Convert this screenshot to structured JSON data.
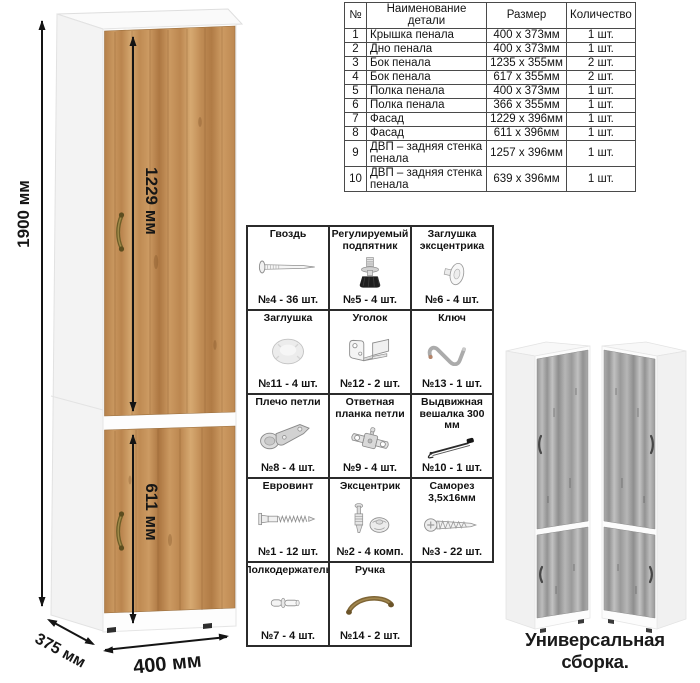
{
  "diagram": {
    "dimensions": {
      "height": "1900 мм",
      "upper_door": "1229 мм",
      "lower_door": "611 мм",
      "depth": "375 мм",
      "width": "400 мм"
    }
  },
  "parts_table": {
    "headers": {
      "num": "№",
      "name": "Наименование детали",
      "size": "Размер",
      "qty": "Количество"
    },
    "rows": [
      {
        "num": "1",
        "name": "Крышка пенала",
        "size": "400 x 373мм",
        "qty": "1 шт."
      },
      {
        "num": "2",
        "name": "Дно пенала",
        "size": "400 x 373мм",
        "qty": "1 шт."
      },
      {
        "num": "3",
        "name": "Бок пенала",
        "size": "1235 x 355мм",
        "qty": "2 шт."
      },
      {
        "num": "4",
        "name": "Бок пенала",
        "size": "617 x 355мм",
        "qty": "2 шт."
      },
      {
        "num": "5",
        "name": "Полка пенала",
        "size": "400 x 373мм",
        "qty": "1 шт."
      },
      {
        "num": "6",
        "name": "Полка пенала",
        "size": "366 x 355мм",
        "qty": "1 шт."
      },
      {
        "num": "7",
        "name": "Фасад",
        "size": "1229 x 396мм",
        "qty": "1 шт."
      },
      {
        "num": "8",
        "name": "Фасад",
        "size": "611 x 396мм",
        "qty": "1 шт."
      },
      {
        "num": "9",
        "name": "ДВП – задняя стенка пенала",
        "size": "1257 x 396мм",
        "qty": "1 шт."
      },
      {
        "num": "10",
        "name": "ДВП – задняя стенка пенала",
        "size": "639 x 396мм",
        "qty": "1 шт."
      }
    ]
  },
  "hardware": {
    "items": [
      {
        "label": "Гвоздь",
        "count": "№4 - 36 шт.",
        "icon": "nail-icon"
      },
      {
        "label": "Регулируемый подпятник",
        "count": "№5 - 4 шт.",
        "icon": "adjustable-foot-icon"
      },
      {
        "label": "Заглушка эксцентрика",
        "count": "№6 - 4 шт.",
        "icon": "cam-cover-icon"
      },
      {
        "label": "Заглушка",
        "count": "№11 - 4 шт.",
        "icon": "cap-icon"
      },
      {
        "label": "Уголок",
        "count": "№12 - 2 шт.",
        "icon": "corner-bracket-icon"
      },
      {
        "label": "Ключ",
        "count": "№13 - 1 шт.",
        "icon": "hex-key-icon"
      },
      {
        "label": "Плечо петли",
        "count": "№8 - 4 шт.",
        "icon": "hinge-arm-icon"
      },
      {
        "label": "Ответная планка петли",
        "count": "№9 - 4 шт.",
        "icon": "hinge-plate-icon"
      },
      {
        "label": "Выдвижная вешалка 300 мм",
        "count": "№10 - 1 шт.",
        "icon": "pullout-hanger-icon"
      },
      {
        "label": "Евровинт",
        "count": "№1 - 12 шт.",
        "icon": "confirmat-screw-icon"
      },
      {
        "label": "Эксцентрик",
        "count": "№2 - 4 комп.",
        "icon": "cam-lock-icon"
      },
      {
        "label": "Саморез 3,5х16мм",
        "count": "№3 - 22 шт.",
        "icon": "self-tapping-screw-icon"
      },
      {
        "label": "Полкодержатель",
        "count": "№7 - 4 шт.",
        "icon": "shelf-pin-icon"
      },
      {
        "label": "Ручка",
        "count": "№14 - 2 шт.",
        "icon": "furniture-handle-icon"
      }
    ]
  },
  "footer": {
    "caption": "Универсальная сборка."
  },
  "colors": {
    "oak": "#c6935a",
    "gray_oak": "#a9a9a9",
    "carcass_white": "#fbfbfb",
    "bronze_handle": "#7c6a33",
    "dimension_line": "#141414",
    "table_border": "#4a4a4a"
  }
}
